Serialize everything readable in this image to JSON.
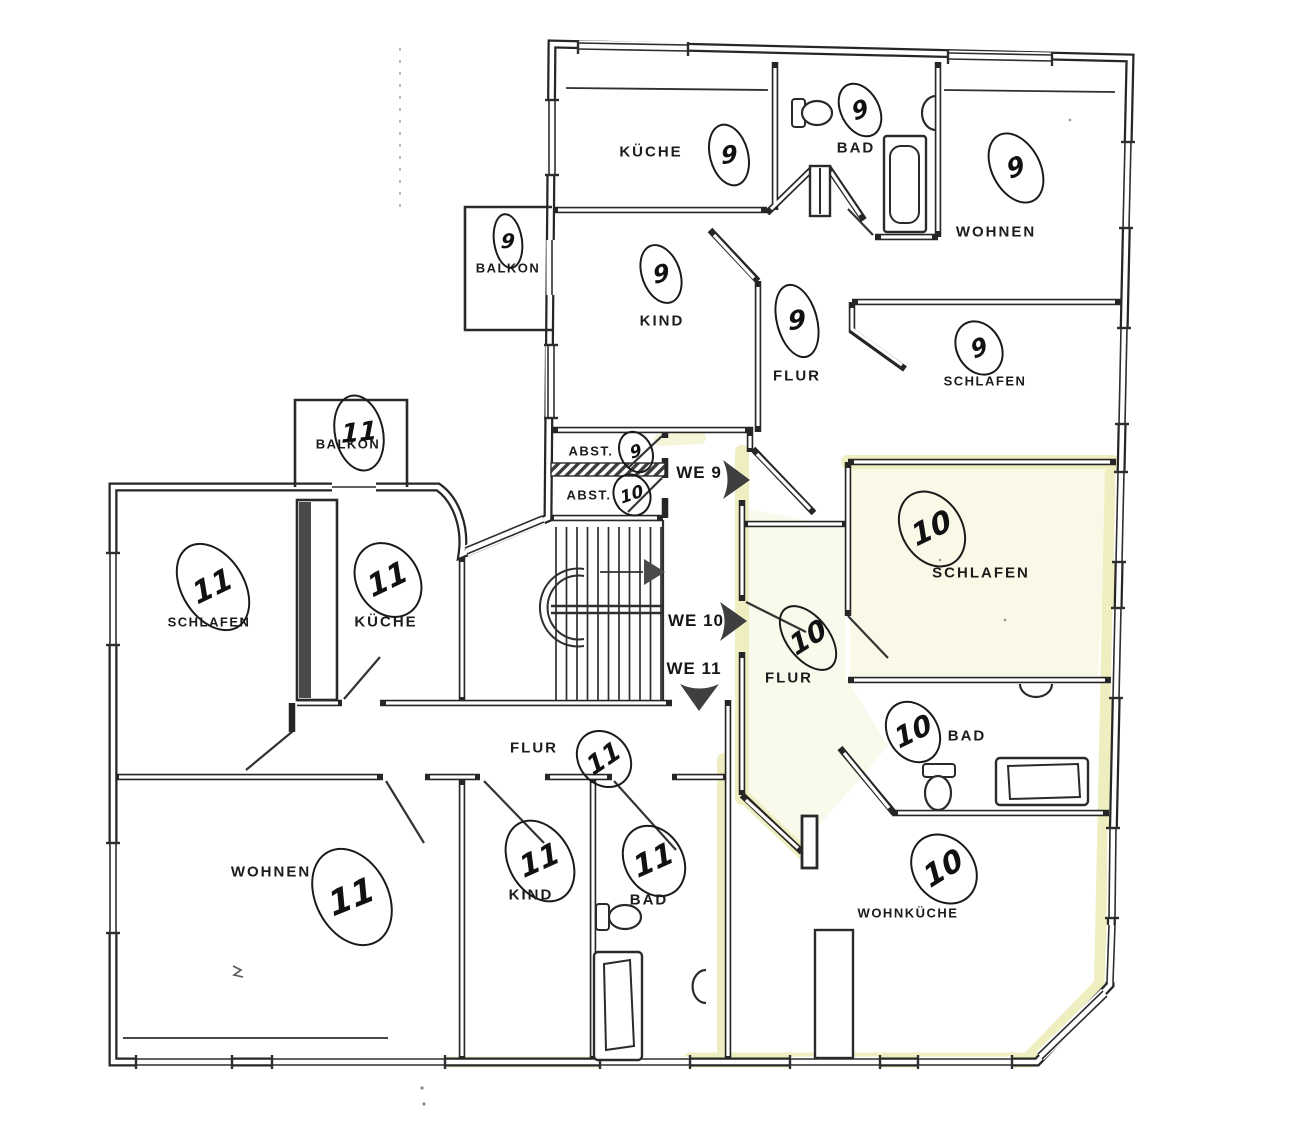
{
  "plan": {
    "type": "floor-plan",
    "units": {
      "we9": "WE 9",
      "we10": "WE 10",
      "we11": "WE 11"
    },
    "rooms": {
      "kueche9": {
        "label": "KÜCHE",
        "unit": "9"
      },
      "bad9": {
        "label": "BAD",
        "unit": "9"
      },
      "wohnen9": {
        "label": "WOHNEN",
        "unit": "9"
      },
      "balkon9": {
        "label": "BALKON",
        "unit": "9"
      },
      "kind9": {
        "label": "KIND",
        "unit": "9"
      },
      "flur9": {
        "label": "FLUR",
        "unit": "9"
      },
      "schlafen9": {
        "label": "SCHLAFEN",
        "unit": "9"
      },
      "abst9": {
        "label": "ABST.",
        "unit": "9"
      },
      "abst10": {
        "label": "ABST.",
        "unit": "10"
      },
      "schlafen10": {
        "label": "SCHLAFEN",
        "unit": "10"
      },
      "flur10": {
        "label": "FLUR",
        "unit": "10"
      },
      "bad10": {
        "label": "BAD",
        "unit": "10"
      },
      "wohnkueche10": {
        "label": "WOHNKÜCHE",
        "unit": "10"
      },
      "balkon11": {
        "label": "BALKON",
        "unit": "11"
      },
      "schlafen11": {
        "label": "SCHLAFEN",
        "unit": "11"
      },
      "kueche11": {
        "label": "KÜCHE",
        "unit": "11"
      },
      "flur11": {
        "label": "FLUR",
        "unit": "11"
      },
      "wohnen11": {
        "label": "WOHNEN",
        "unit": "11"
      },
      "kind11": {
        "label": "KIND",
        "unit": "11"
      },
      "bad11": {
        "label": "BAD",
        "unit": "11"
      }
    },
    "colors": {
      "highlight": "#efeec0",
      "ink": "#262626"
    }
  }
}
